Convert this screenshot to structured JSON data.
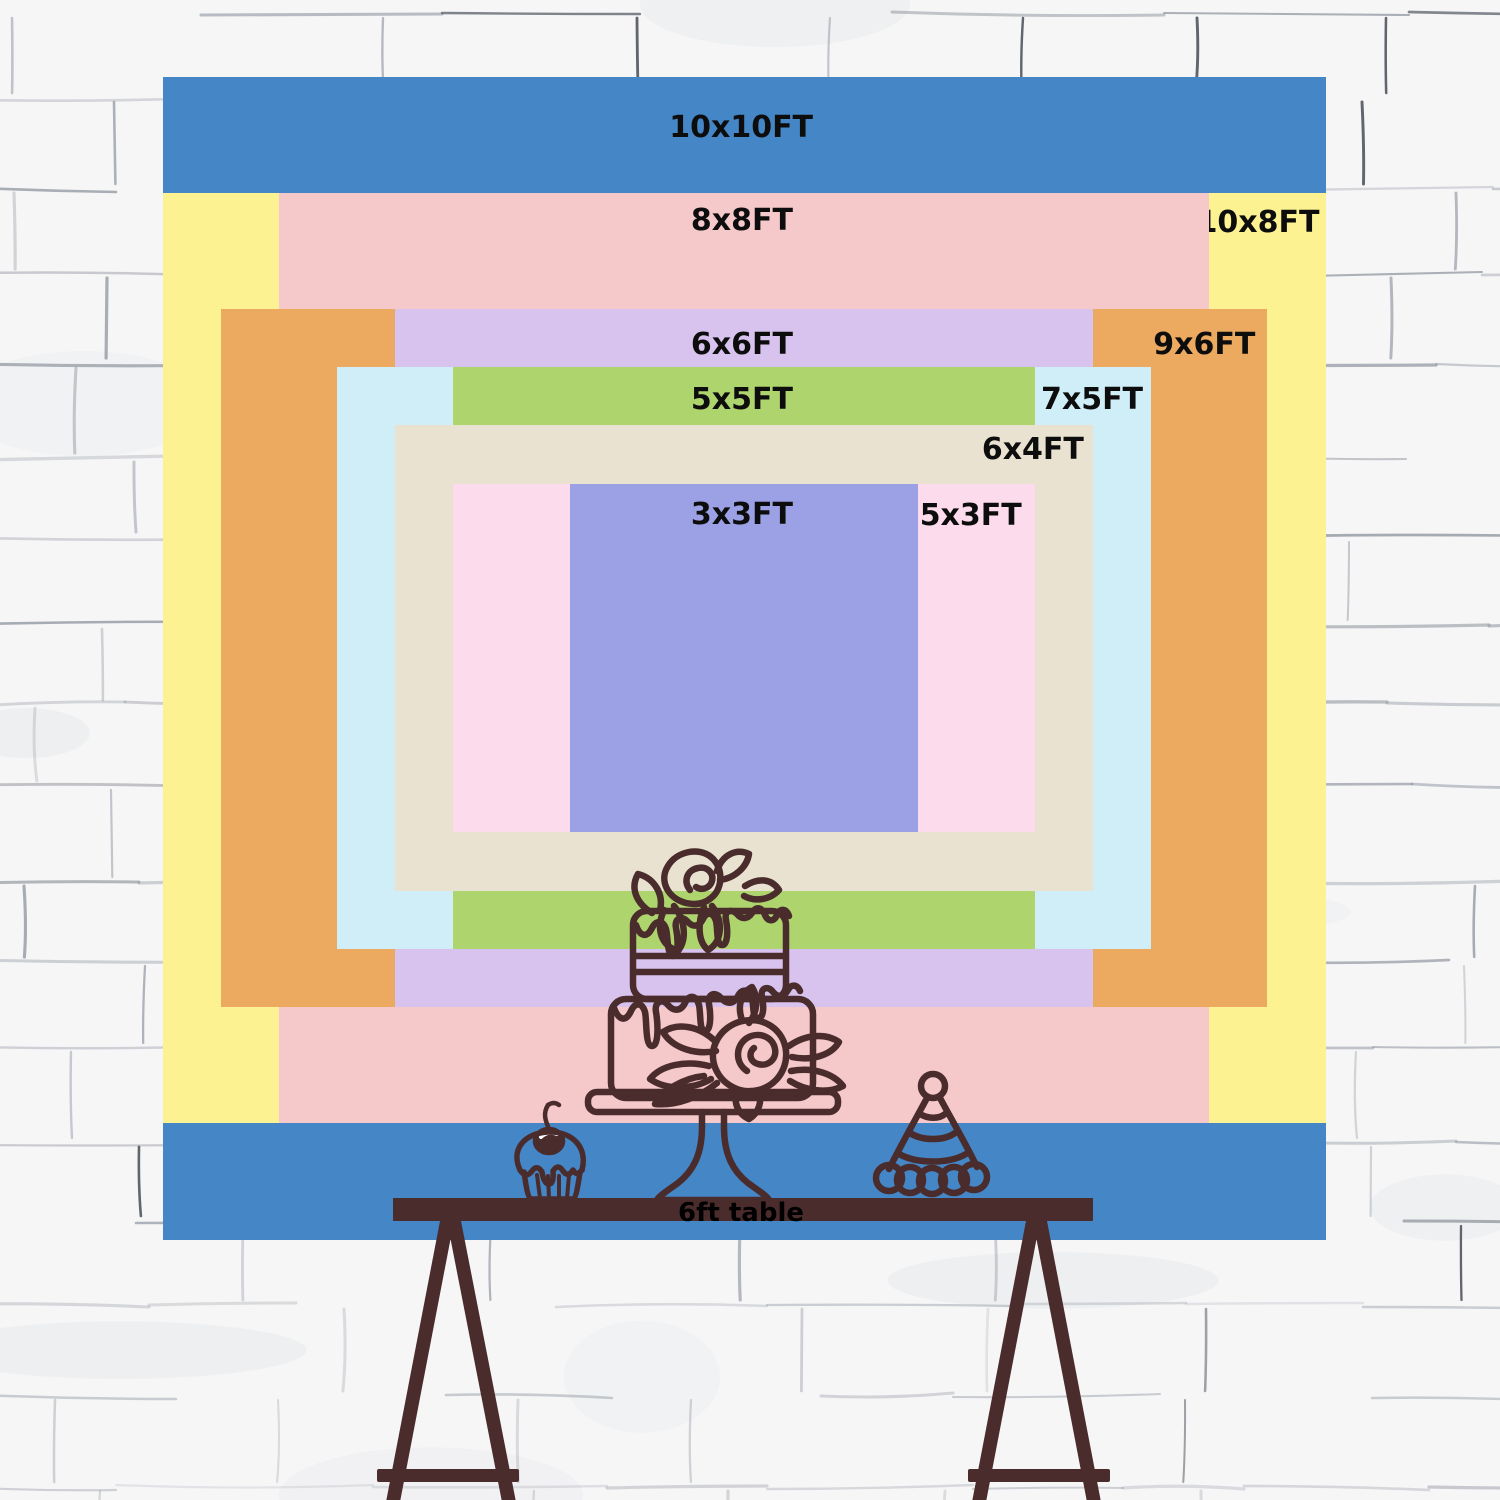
{
  "page": {
    "description": "Backdrop size comparison chart on a white brick wall with a 6ft table illustration"
  },
  "chart_data": {
    "type": "nested-size-diagram",
    "unit": "FT",
    "px_per_ft": 116.3,
    "center_x": 744,
    "center_y": 658,
    "table_label": "6ft table",
    "sizes": [
      {
        "label": "10x10FT",
        "w": 10,
        "h": 10,
        "color": "#4486c6",
        "placement": "center",
        "top": 34
      },
      {
        "label": "8x8FT",
        "w": 8,
        "h": 8,
        "color": "#f5c8ca",
        "placement": "center",
        "top": 11
      },
      {
        "label": "10x8FT",
        "w": 10,
        "h": 8,
        "color": "#fcf292",
        "placement": "right",
        "top": 13,
        "right": 6
      },
      {
        "label": "6x6FT",
        "w": 6,
        "h": 6,
        "color": "#d7c3ee",
        "placement": "center",
        "top": 19
      },
      {
        "label": "9x6FT",
        "w": 9,
        "h": 6,
        "color": "#ebaa60",
        "placement": "right",
        "top": 19,
        "right": 12
      },
      {
        "label": "5x5FT",
        "w": 5,
        "h": 5,
        "color": "#aed46e",
        "placement": "center",
        "top": 16
      },
      {
        "label": "7x5FT",
        "w": 7,
        "h": 5,
        "color": "#cfeef8",
        "placement": "right",
        "top": 16,
        "right": 8
      },
      {
        "label": "6x4FT",
        "w": 6,
        "h": 4,
        "color": "#e9e2d0",
        "placement": "right",
        "top": 8,
        "right": 9
      },
      {
        "label": "5x3FT",
        "w": 5,
        "h": 3,
        "color": "#fcdcec",
        "placement": "right",
        "top": 15,
        "right": 13
      },
      {
        "label": "3x3FT",
        "w": 3,
        "h": 3,
        "color": "#9ca0e4",
        "placement": "center",
        "top": 14
      }
    ]
  },
  "illustration": {
    "line_color": "#4a2c2c",
    "items": [
      "two-tier cake on stand with roses",
      "cupcake with cherry",
      "party hat",
      "trestle table"
    ]
  }
}
